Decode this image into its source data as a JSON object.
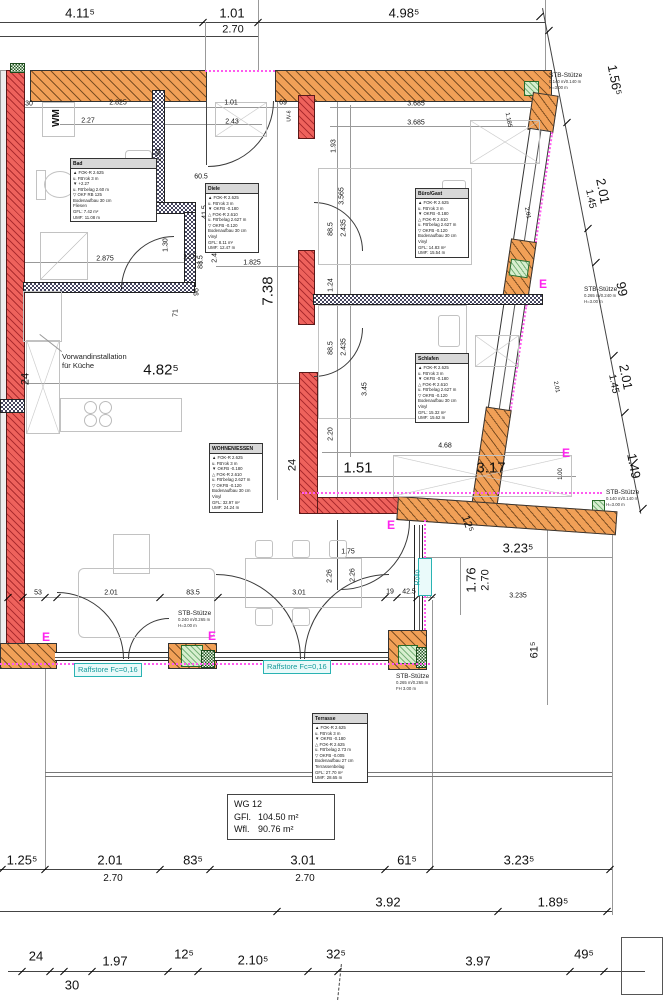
{
  "d": {
    "top": [
      "4.11⁵",
      "1.01",
      "2.70",
      "4.98⁵"
    ],
    "right": [
      "1.56⁵",
      "2.01",
      "1.45",
      "99",
      "2.01",
      "1.45",
      "1.49"
    ],
    "inner": [
      "30",
      "2.825",
      "2.27",
      "1.01",
      "69",
      "2.43",
      "3.685",
      "3.685",
      "1.185",
      "1.93",
      "3.565",
      "1.94",
      "60.5",
      "41.5",
      "88.5",
      "2.435",
      "12.5",
      "1.30",
      "2.875",
      "1.825",
      "96",
      "71",
      "88.5",
      "2.435",
      "1.24",
      "88.5",
      "2.435",
      "7.38",
      "24",
      "4.82⁵",
      "3.45",
      "2.20",
      "4.68",
      "1.51",
      "3.17",
      "24",
      "1.00",
      "2.01",
      "2.01",
      "1.75",
      "2.26",
      "2.26",
      "3.01",
      "53",
      "2.01",
      "83.5",
      "19",
      "42.5",
      "2.50",
      "3.235",
      "1.76",
      "2.70",
      "3.23⁵",
      "12⁵",
      "61⁵",
      "UV-6"
    ],
    "row1": [
      "1.25⁵",
      "2.01",
      "2.70",
      "83⁵",
      "3.01",
      "2.70",
      "61⁵",
      "3.23⁵"
    ],
    "row2": [
      "3.92",
      "1.89⁵"
    ],
    "row3": [
      "24",
      "30",
      "1.97",
      "12⁵",
      "2.10⁵",
      "32⁵",
      "3.97",
      "49⁵"
    ]
  },
  "labels": {
    "vorwand": [
      "Vorwandinstallation",
      "für Küche"
    ],
    "raffstore": "Raffstore Fc=0,16",
    "rollo": "Rollo",
    "wm": "WM",
    "e_mark": "E"
  },
  "stb": {
    "name": "STB-Stütze",
    "s1": [
      "0.140 m/0.140 m",
      "H=3.00 m"
    ],
    "s2": [
      "0.265 m/0.240 m",
      "H=3.00 m"
    ],
    "s3": [
      "0.140 m/0.140 m",
      "H=3.00 m"
    ],
    "s4": [
      "0.240 m/0.265 m",
      "H=3.00 m"
    ],
    "s5": [
      "0.265 m/0.265 m",
      "FH 3.00 m"
    ]
  },
  "unit": {
    "id": "WG 12",
    "gfl_label": "GFl.",
    "gfl": "104.50 m²",
    "wfl_label": "Wfl.",
    "wfl": "90.76 m²"
  },
  "rooms": {
    "bad": {
      "name": "Bad",
      "lines": [
        "▲ FOK-R 2.625",
        "u. FB'rok 3 m",
        "▼ +2.27",
        "u. FB'belag 2.60 m",
        "▽ OKF RB 125",
        "Bodenaufbau 30 cm",
        "Fliesen",
        "GFL: 7.42 m²",
        "UMF: 11.08 m"
      ]
    },
    "diele": {
      "name": "Diele",
      "lines": [
        "▲ FOK-R 2.625",
        "u. FB'rok 3 m",
        "▼ OKFB -0.180",
        "△ FOK-R 2.610",
        "u. FB'belag 2.627 m",
        "▽ OKFB -0.120",
        "Bodenaufbau 30 cm",
        "Vinyl",
        "GFL: 8.11 m²",
        "UMF: 12.47 m"
      ]
    },
    "buero": {
      "name": "Büro/Gast",
      "lines": [
        "▲ FOK-R 2.625",
        "u. FB'rok 3 m",
        "▼ OKFB -0.180",
        "△ FOK-R 2.610",
        "u. FB'belag 2.627 m",
        "▽ OKFB -0.120",
        "Bodenaufbau 30 cm",
        "Vinyl",
        "GFL: 14.83 m²",
        "UMF: 15.54 m"
      ]
    },
    "schlafen": {
      "name": "Schlafen",
      "lines": [
        "▲ FOK-R 2.625",
        "u. FB'rok 3 m",
        "▼ OKFB -0.180",
        "△ FOK-R 2.610",
        "u. FB'belag 2.627 m",
        "▽ OKFB -0.120",
        "Bodenaufbau 30 cm",
        "Vinyl",
        "GFL: 15.32 m²",
        "UMF: 15.62 m"
      ]
    },
    "wohnen": {
      "name": "WOHNEN/ESSEN",
      "lines": [
        "▲ FOK-R 2.625",
        "u. FB'rok 3 m",
        "▼ OKFB -0.180",
        "△ FOK-R 2.610",
        "u. FB'belag 2.627 m",
        "▽ OKFB -0.120",
        "Bodenaufbau 30 cm",
        "Vinyl",
        "GFL: 32.97 m²",
        "UMF: 24.24 m"
      ]
    },
    "terrasse": {
      "name": "Terrasse",
      "lines": [
        "▲ FOK-R 2.625",
        "u. FB'rok 3 m",
        "▼ OKFB -0.180",
        "△ FOK-R 2.625",
        "u. FB'belag 2.73 m",
        "▽ OKFB -0.005",
        "Bodenaufbau 27 cm",
        "Terrassenbelag",
        "GFL: 27.70 m²",
        "UMF: 28.65 m"
      ]
    }
  }
}
